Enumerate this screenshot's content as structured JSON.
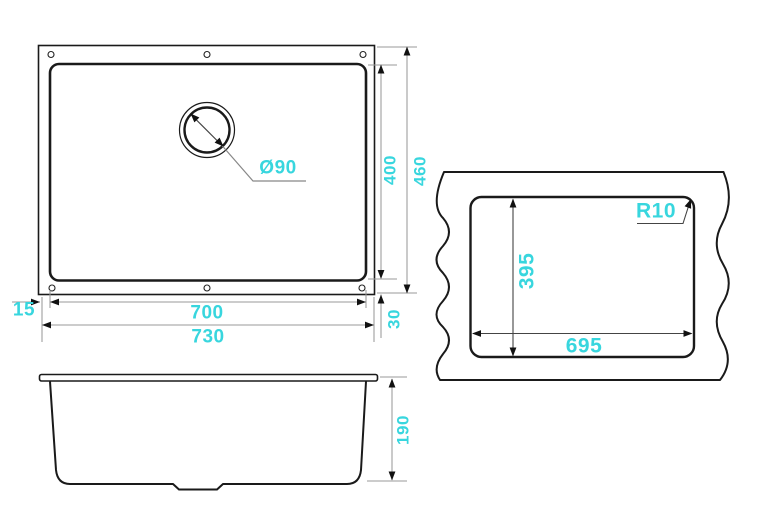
{
  "drawing": {
    "accent_color": "#38d6de",
    "outline_color": "#1a1a1a",
    "dim_line_color": "#999999",
    "top_view": {
      "drain_diameter": "Ø90",
      "inner_depth": "400",
      "outer_depth": "460",
      "rim_offset_left": "15",
      "inner_width": "700",
      "outer_width": "730",
      "rim_offset_bottom": "30"
    },
    "cutout_view": {
      "corner_radius": "R10",
      "cutout_depth": "395",
      "cutout_width": "695"
    },
    "side_view": {
      "bowl_height": "190"
    }
  }
}
